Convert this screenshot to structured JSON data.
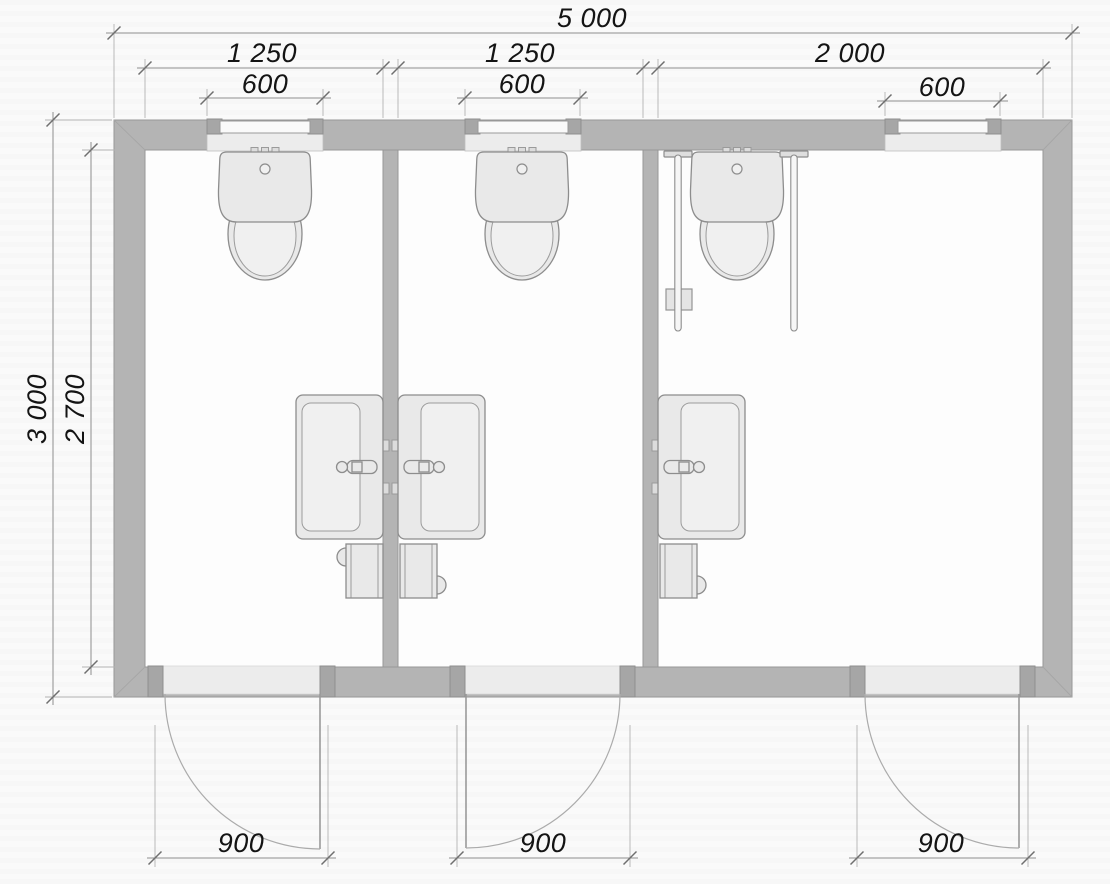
{
  "dimensions": {
    "overall_width": "5 000",
    "room_1_width": "1 250",
    "room_2_width": "1 250",
    "room_3_width": "2 000",
    "window_1_width": "600",
    "window_2_width": "600",
    "window_3_width": "600",
    "overall_depth": "3 000",
    "interior_depth": "2 700",
    "door_1_width": "900",
    "door_2_width": "900",
    "door_3_width": "900"
  },
  "colors": {
    "wall": "#b4b4b4",
    "fixture_fill": "#e9e9e9",
    "dimension_text": "#141414",
    "line": "#8f8f8f"
  }
}
